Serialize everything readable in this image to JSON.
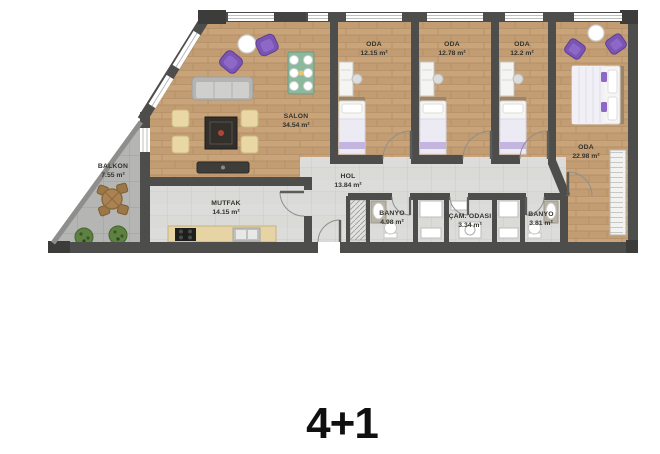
{
  "plan": {
    "type_label": "4+1",
    "rooms": {
      "salon": {
        "name": "SALON",
        "area": "34.54 m²"
      },
      "balkon": {
        "name": "BALKON",
        "area": "7.55 m²"
      },
      "mutfak": {
        "name": "MUTFAK",
        "area": "14.15 m²"
      },
      "hol": {
        "name": "HOL",
        "area": "13.84 m²"
      },
      "oda1": {
        "name": "ODA",
        "area": "12.15 m²"
      },
      "oda2": {
        "name": "ODA",
        "area": "12.78 m²"
      },
      "oda3": {
        "name": "ODA",
        "area": "12.2 m²"
      },
      "oda4": {
        "name": "ODA",
        "area": "22.98 m²"
      },
      "banyo1": {
        "name": "BANYO",
        "area": "4.98 m²"
      },
      "cam_odasi": {
        "name": "ÇAM. ODASI",
        "area": "3.34 m²"
      },
      "banyo2": {
        "name": "BANYO",
        "area": "3.81 m²"
      }
    },
    "colors": {
      "wall": "#4d4d4b",
      "wood_floor": "#c9a47b",
      "tile_floor": "#dcdcda",
      "balcony_floor": "#b5b6b4",
      "accent_purple": "#7a55b4",
      "accent_green": "#8cb99d"
    }
  }
}
